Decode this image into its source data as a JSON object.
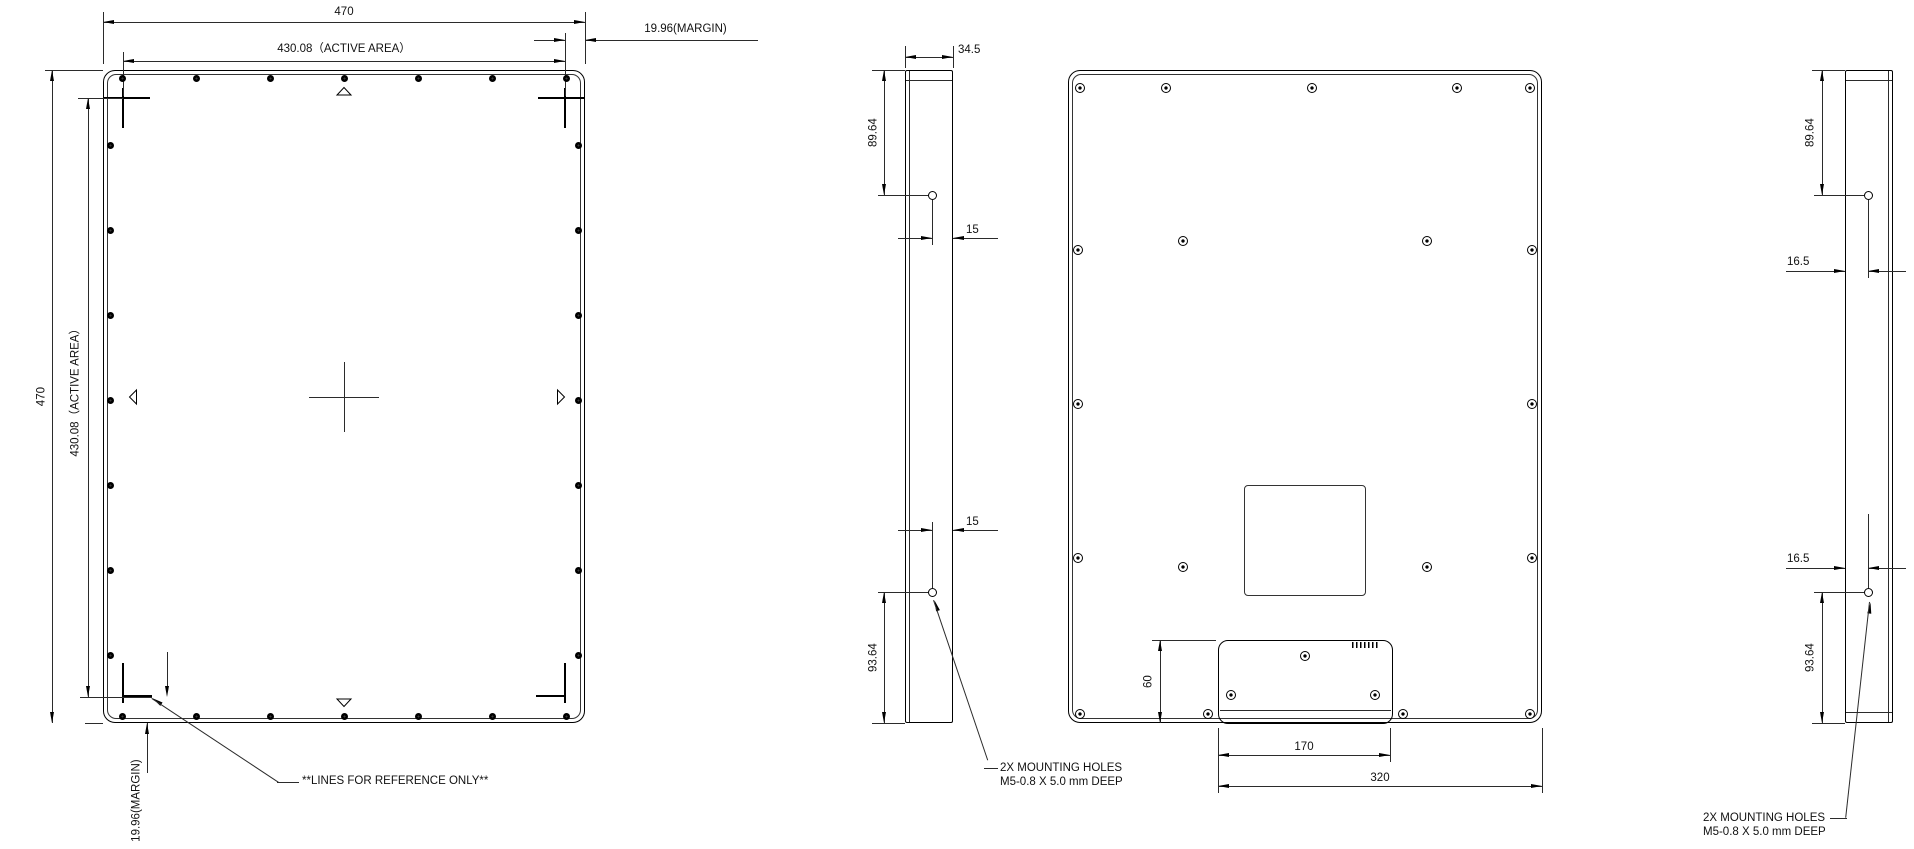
{
  "views": {
    "front": {
      "dim_width": "470",
      "dim_width_active": "430.08（ACTIVE AREA）",
      "dim_height": "470",
      "dim_height_active": "430.08（ACTIVE AREA）",
      "margin_top": "19.96(MARGIN)",
      "margin_bottom": "19.96(MARGIN)",
      "reference_note": "**LINES FOR REFERENCE ONLY**"
    },
    "side_left": {
      "dim_thickness": "34.5",
      "dim_top_hole": "89.64",
      "dim_top_hole_offset": "15",
      "dim_bottom_hole_offset": "15",
      "dim_bottom_hole": "93.64",
      "mounting_note_line1": "2X MOUNTING HOLES",
      "mounting_note_line2": "M5-0.8 X 5.0 mm DEEP"
    },
    "back": {
      "dim_connector_height": "60",
      "dim_connector_width": "170",
      "dim_connector_span": "320"
    },
    "side_right": {
      "dim_top_hole": "89.64",
      "dim_top_hole_offset": "16.5",
      "dim_bottom_hole_offset": "16.5",
      "dim_bottom_hole": "93.64",
      "mounting_note_line1": "2X MOUNTING HOLES",
      "mounting_note_line2": "M5-0.8 X 5.0 mm DEEP"
    }
  }
}
